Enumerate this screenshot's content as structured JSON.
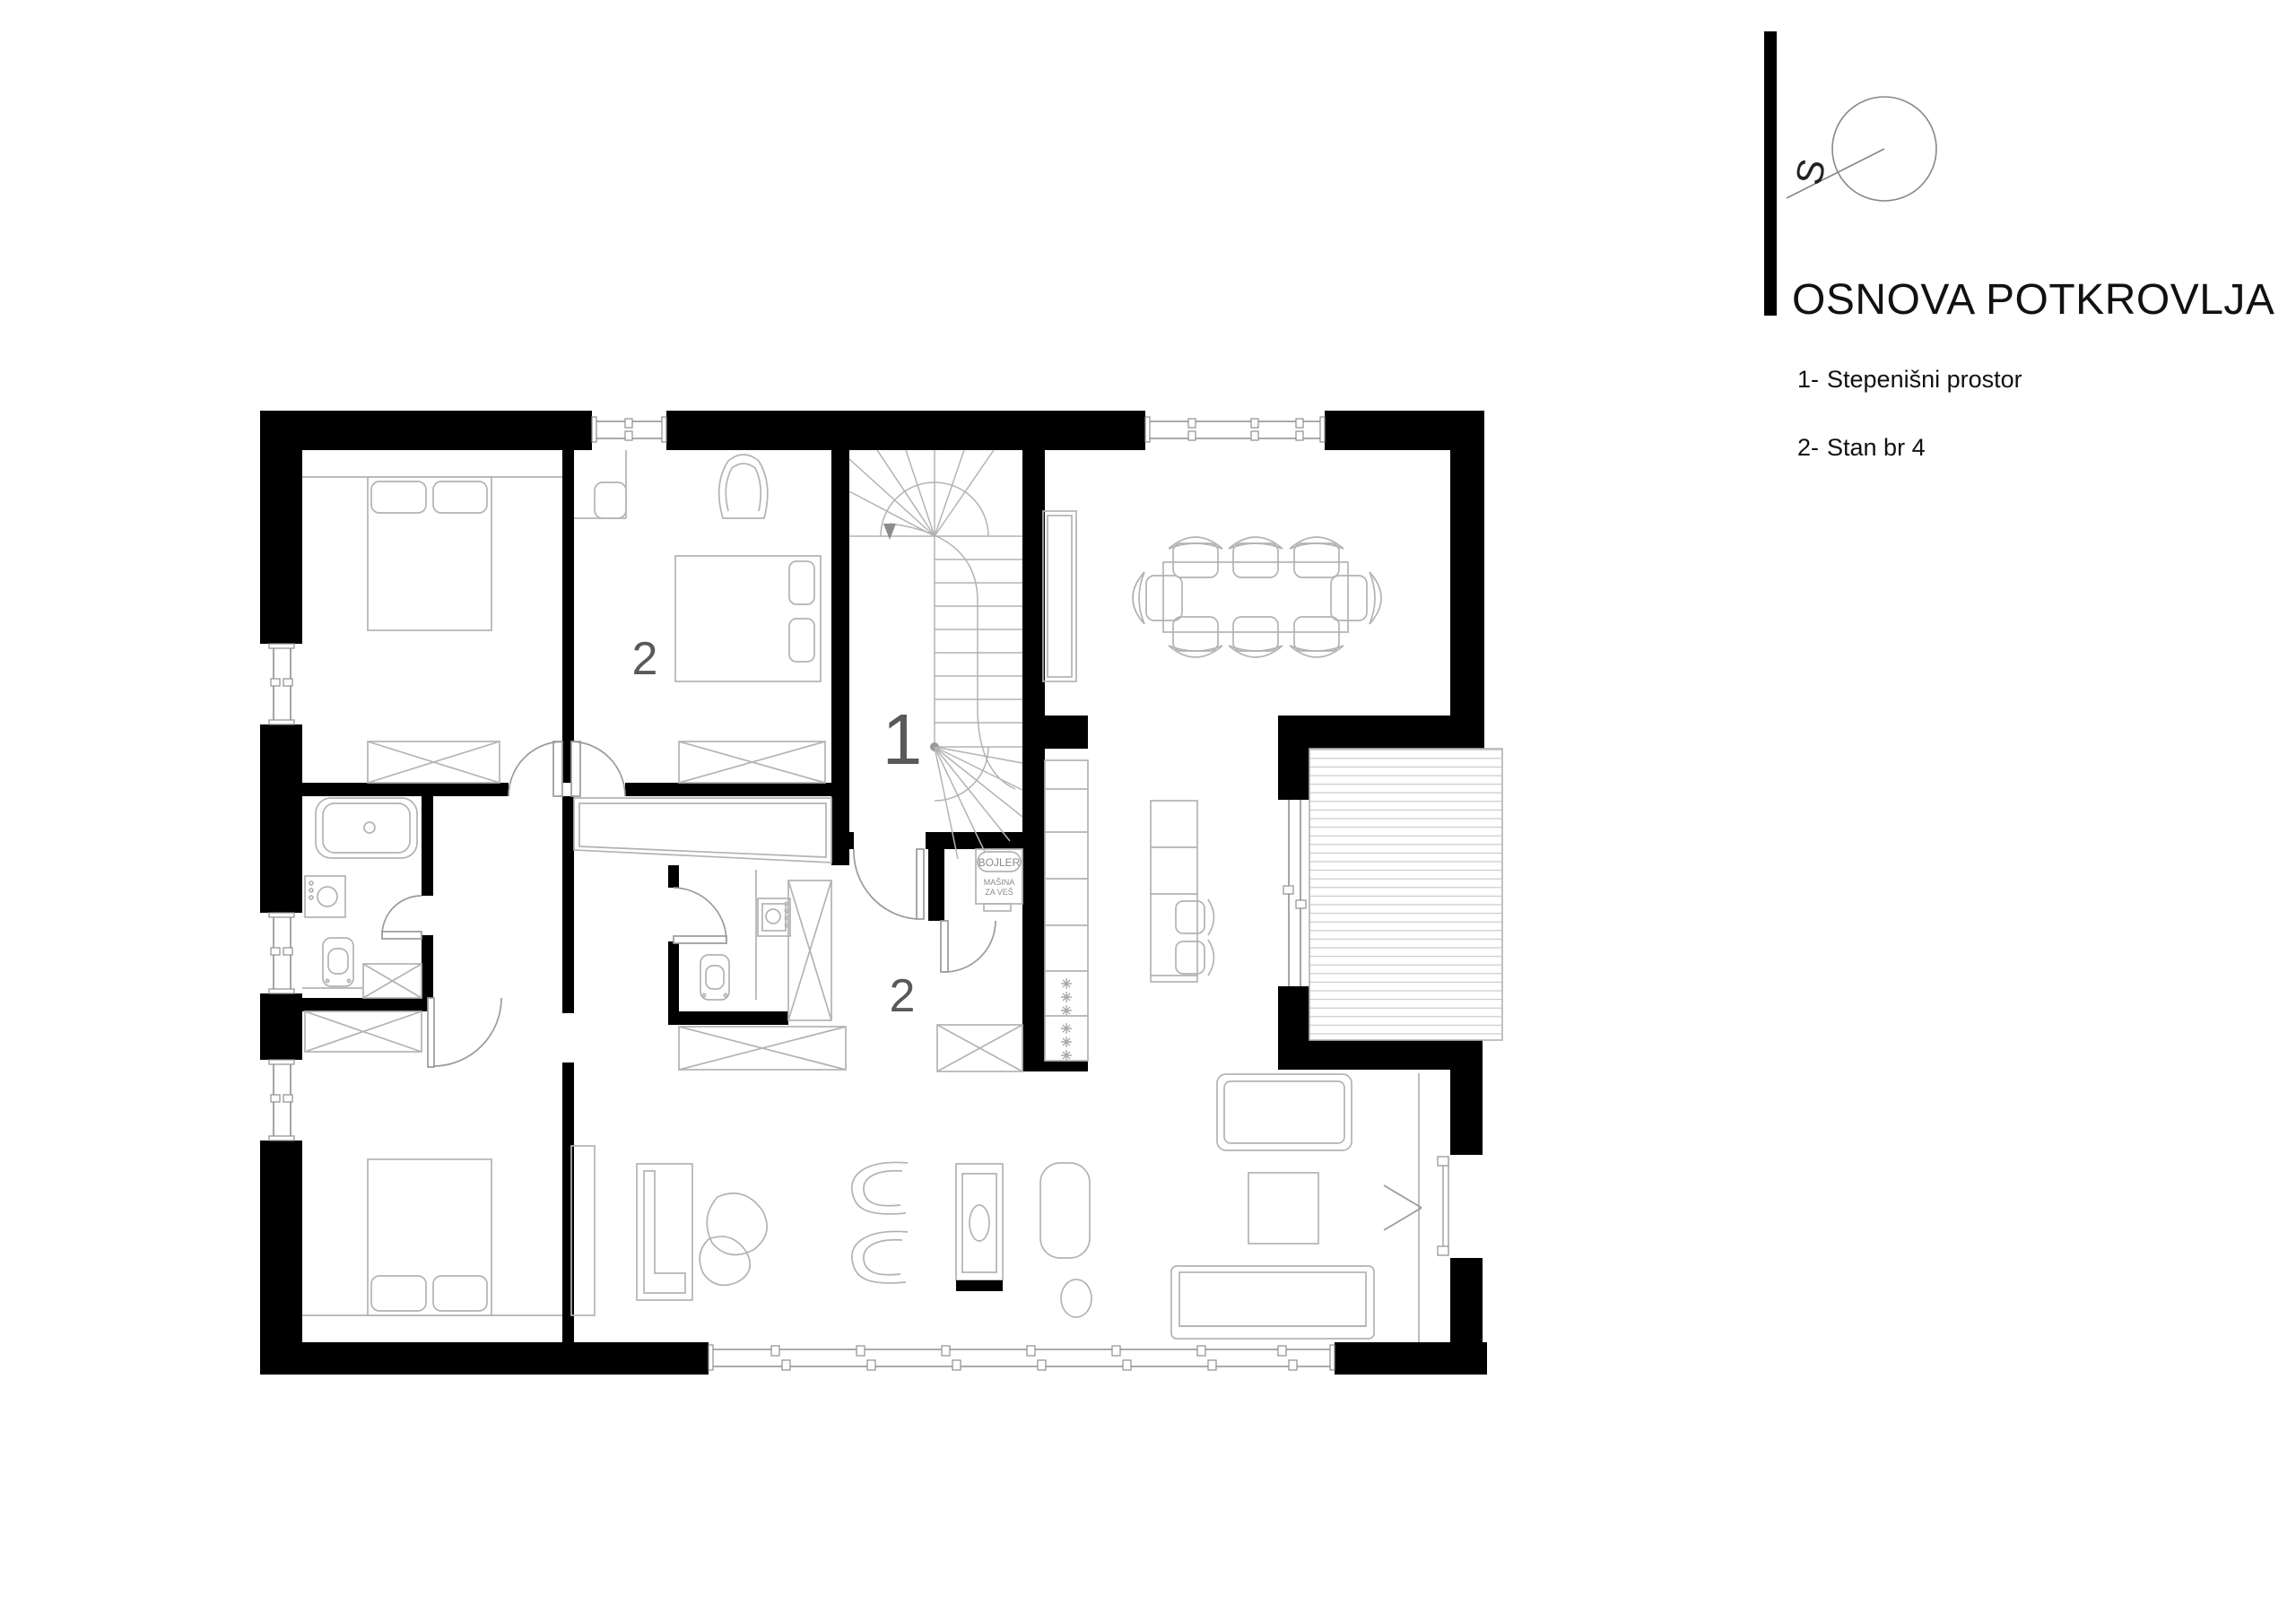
{
  "title_block": {
    "title": "OSNOVA POTKROVLJA",
    "legend": [
      {
        "num": "1-",
        "label": "Stepenišni prostor"
      },
      {
        "num": "2-",
        "label": "Stan br 4"
      }
    ],
    "compass_letter": "S"
  },
  "plan": {
    "labels": {
      "stairwell": "1",
      "upper_room": "2",
      "vestibule": "2"
    },
    "utility": {
      "boiler": "BOJLER",
      "washer_line1": "MAŠINA",
      "washer_line2": "ZA VEŠ"
    },
    "colors": {
      "wall": "#000000",
      "furniture_line": "#b3b3b3",
      "window_line": "#8f8f8f",
      "balcony_hatch": "#c9c9c9",
      "room_label": "#595959"
    }
  }
}
